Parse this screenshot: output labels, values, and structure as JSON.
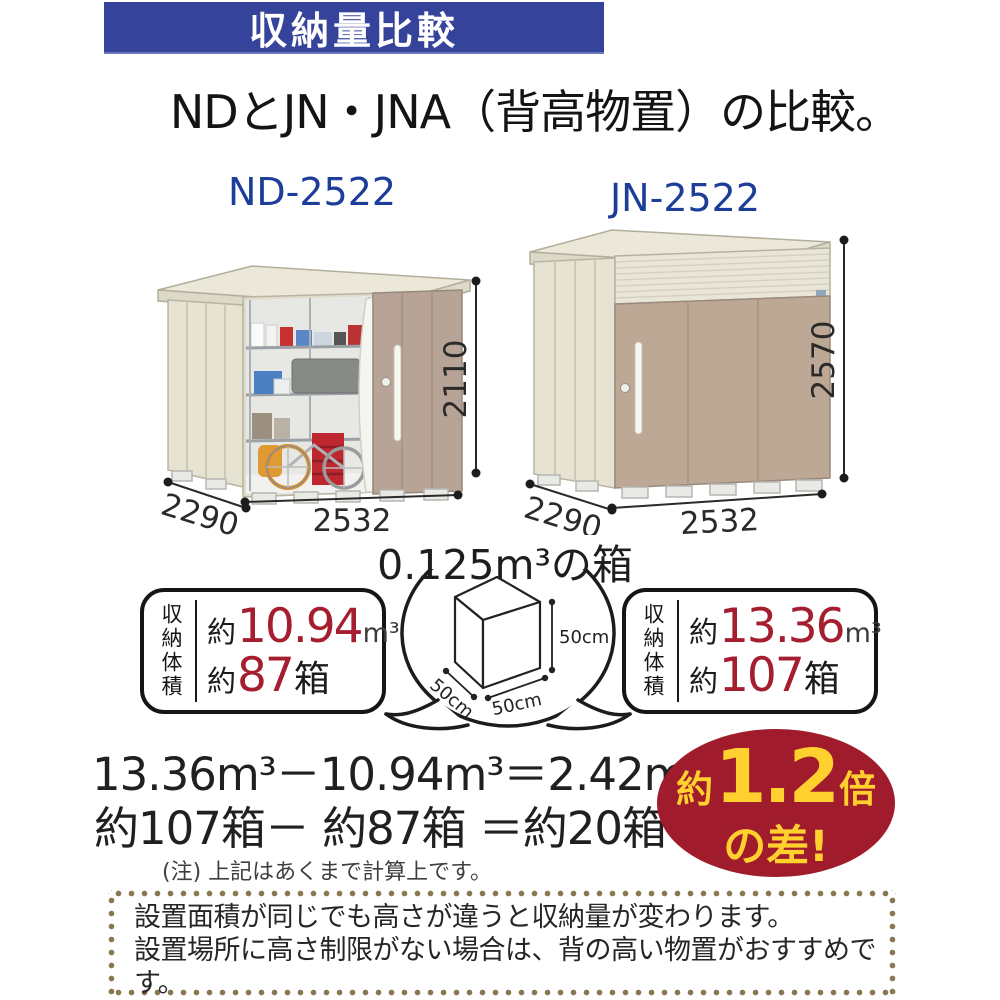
{
  "banner": {
    "title": "収納量比較"
  },
  "heading": "NDとJN・JNA（背高物置）の比較。",
  "sheds": {
    "left": {
      "model": "ND-2522",
      "height": "2110",
      "depth": "2290",
      "width": "2532"
    },
    "right": {
      "model": "JN-2522",
      "height": "2570",
      "depth": "2290",
      "width": "2532"
    }
  },
  "box_callout": {
    "title": "0.125m³の箱",
    "dim_height": "50cm",
    "dim_width": "50cm",
    "dim_depth": "50cm"
  },
  "stats": {
    "left": {
      "label": "収納体積",
      "volume_prefix": "約",
      "volume_value": "10.94",
      "volume_unit": "m³",
      "boxes_prefix": "約",
      "boxes_value": "87",
      "boxes_unit": "箱"
    },
    "right": {
      "label": "収納体積",
      "volume_prefix": "約",
      "volume_value": "13.36",
      "volume_unit": "m³",
      "boxes_prefix": "約",
      "boxes_value": "107",
      "boxes_unit": "箱"
    }
  },
  "calculation": {
    "line_volume": "13.36m³－10.94m³＝2.42m³",
    "line_boxes": "約107箱－ 約87箱 ＝約20箱",
    "note": "(注) 上記はあくまで計算上です。"
  },
  "badge": {
    "prefix": "約",
    "value": "1.2",
    "suffix": "倍",
    "line2": "の差!"
  },
  "footer_note": {
    "lines": [
      "設置面積が同じでも高さが違うと収納量が変わります。",
      "設置場所に高さ制限がない場合は、背の高い物置がおすすめです。",
      "土地を有効に活用できより経済的です。"
    ]
  },
  "colors": {
    "banner_blue": "#35439b",
    "model_blue": "#1c3e99",
    "value_red": "#a51e2f",
    "badge_red": "#a01b2c",
    "badge_yellow": "#ffd02e",
    "shed_cream": "#e8e4d4",
    "door_tan": "#bda795",
    "dotted_border_brown": "#8a7950"
  }
}
